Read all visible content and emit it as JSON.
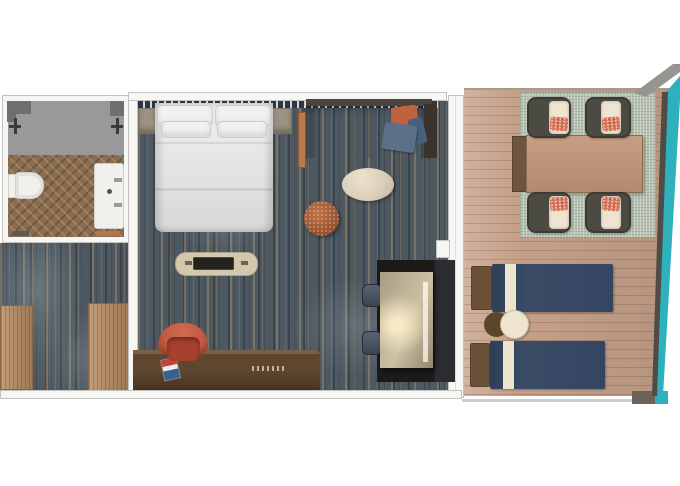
{
  "plan": {
    "scene": "cruise-ship-stateroom-floor-plan-top-view",
    "rooms": [
      {
        "id": "bathroom",
        "furniture": [
          "shower",
          "shower-fixtures",
          "toilet",
          "vanity-sink",
          "threshold",
          "bath-mat"
        ]
      },
      {
        "id": "entry-hall",
        "furniture": [
          "wardrobe-left",
          "wardrobe-right"
        ]
      },
      {
        "id": "main-cabin",
        "furniture": [
          "headboard-panel",
          "queen-bed",
          "bed-pillows",
          "nightstand-left",
          "nightstand-right",
          "sofa",
          "sofa-throw-pillows",
          "coffee-table",
          "ottoman",
          "tv-console",
          "tv-screen",
          "desk",
          "desk-chair",
          "desk-book",
          "dining-nook-table",
          "nook-chairs"
        ]
      },
      {
        "id": "balcony",
        "furniture": [
          "outdoor-rug",
          "dining-table",
          "four-dining-chairs",
          "sun-lounger-upper",
          "sun-lounger-lower",
          "side-tables",
          "railing",
          "ocean-strip"
        ]
      }
    ]
  },
  "colors": {
    "wall": "#f6f6f4",
    "wall_line": "#c2c2be",
    "carpet_base": "#4e5861",
    "shower_gray": "#99989a",
    "shower_dark": "#6f6e72",
    "fixture": "#3a3a3c",
    "bath_floor": "#8a6c4e",
    "porcelain": "#f1f0ed",
    "wood_closet": "#b28a64",
    "wood_strip": "#b9794f",
    "headboard_dark": "#2e3440",
    "headboard_light": "#d4d8dc",
    "nightstand": "#9c9183",
    "pillow": "#f0f0f0",
    "sofa_back": "#4a443c",
    "sofa_arm_dark": "#3a332b",
    "cushion_orange": "#bf6240",
    "cushion_blue": "#5a7187",
    "cushion_navy": "#46607c",
    "coffee_table": "#d9cfba",
    "console": "#d2c8ae",
    "tv": "#24221e",
    "desk": "#46331f",
    "desk_light": "#7d5f45",
    "chair_red": "#c1583f",
    "chair_red_dark": "#a8402f",
    "book_red": "#c04438",
    "book_blue": "#33628e",
    "nook_dark": "#1c1a17",
    "nook_table": "#cdc1a4",
    "nook_chair": "#3c4352",
    "deck": "#c5a089",
    "rug": "#b6c1b0",
    "table_wood": "#b28a70",
    "table_end": "#6e563e",
    "frame_gray": "#4c4b43",
    "cushion_cream": "#efe4d0",
    "pillow_coral": "#d9775a",
    "lounger": "#3a4c66",
    "lounger_stripe": "#eee3cc",
    "headrest": "#6b5138",
    "side_brown": "#5d452c",
    "side_cream": "#eee5d1",
    "teal": "#2fb0bd",
    "rail_dark": "#4e4c44",
    "rail_gray": "#6b6359",
    "band_gray": "#96958f",
    "line_gray": "#cdcdc9"
  }
}
